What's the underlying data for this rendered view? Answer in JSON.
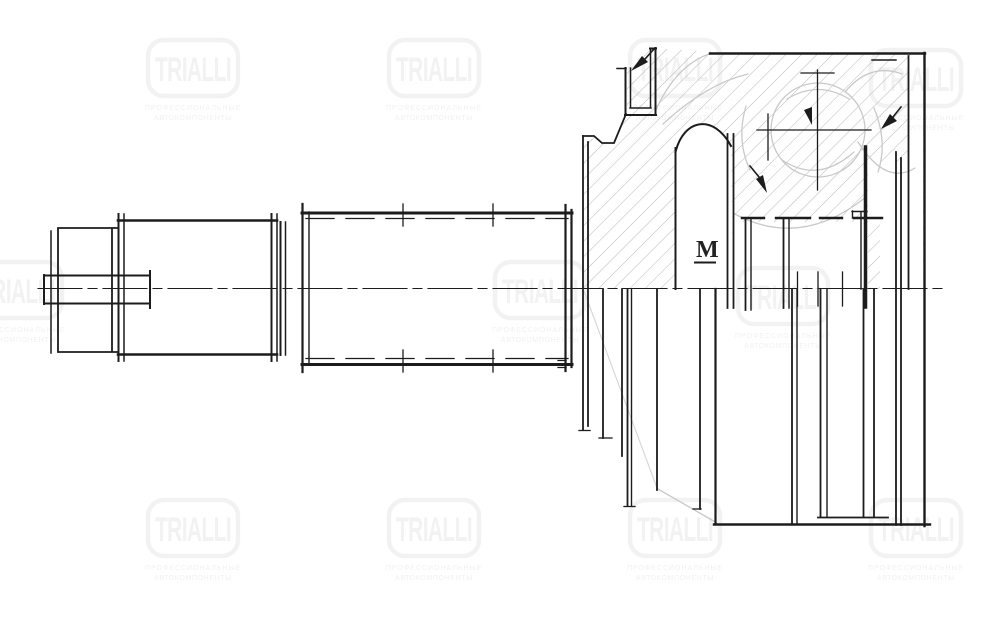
{
  "watermark": {
    "brand": "TRIALLI",
    "subtext_line1": "ПРОФЕССИОНАЛЬНЫЕ",
    "subtext_line2": "АВТОКОМПОНЕНТЫ"
  },
  "annotations": {
    "thread_label": "M"
  },
  "colors": {
    "background": "#ffffff",
    "line": "#1c1c1c",
    "hatch": "#b9b9b9",
    "ghost_outline": "#c9c9c9",
    "watermark": "#f2f2f2",
    "thread_label": "#222222"
  }
}
